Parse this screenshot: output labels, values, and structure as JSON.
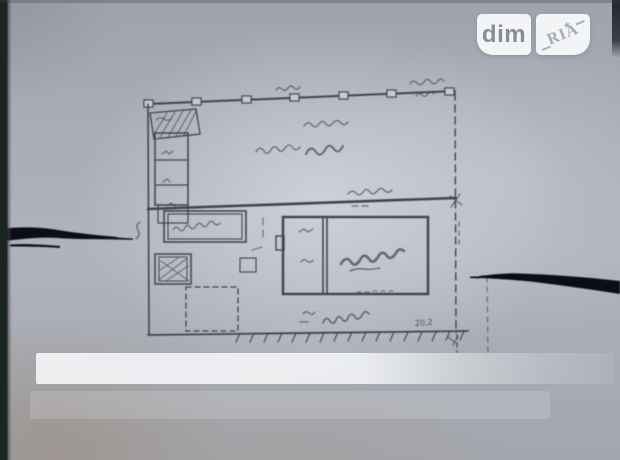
{
  "watermark": {
    "left_text": "dim",
    "right_text": "RIA",
    "star": "★"
  },
  "plan": {
    "dimension_bottom": "20,2"
  },
  "colors": {
    "paper": "#c6cad1",
    "ink": "#3f4450",
    "pen": "#0b0e12",
    "watermark_box": "#f3f4f6",
    "watermark_text": "#878d96",
    "edge_shadow": "#1a2420"
  }
}
